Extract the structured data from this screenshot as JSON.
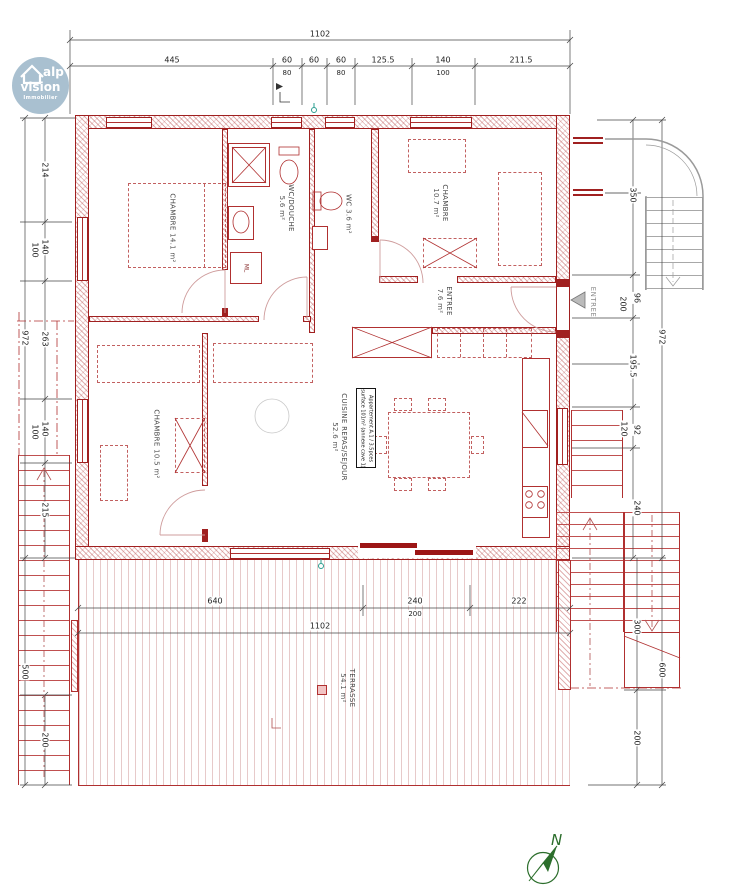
{
  "logo": {
    "brand": "alp",
    "brand2": "vision",
    "brand3": "Immobilier"
  },
  "compass": {
    "north": "N"
  },
  "apartment_box": {
    "line1": "Appartement A.1 / 3.5pces",
    "line2": "surface 101m² (annexe cave 1)"
  },
  "entrance": {
    "label": "ENTREE"
  },
  "fixtures": {
    "washing_machine": "ML"
  },
  "rooms": {
    "chambre1": {
      "name": "CHAMBRE",
      "area": "14.1 m²"
    },
    "wc_douche": {
      "name": "WC/DOUCHE",
      "area": "5.6 m²"
    },
    "wc": {
      "name": "WC",
      "area": "3.6 m²"
    },
    "chambre2": {
      "name": "CHAMBRE",
      "area": "10.7 m²"
    },
    "entree": {
      "name": "ENTREE",
      "area": "7.6 m²"
    },
    "chambre3": {
      "name": "CHAMBRE",
      "area": "10.5 m²"
    },
    "cuisine": {
      "name": "CUISINE REPAS/SEJOUR",
      "area": "52.6 m²"
    },
    "terrasse": {
      "name": "TERRASSE",
      "area": "54.1 m²"
    }
  },
  "dims": {
    "top_total": "1102",
    "top_row": [
      "445",
      "60",
      "60",
      "60",
      "125.5",
      "140",
      "211.5"
    ],
    "top_sub": [
      "80",
      "80",
      "100"
    ],
    "left": [
      "214",
      "140",
      "100",
      "263",
      "140",
      "100",
      "215",
      "200"
    ],
    "left_outer": [
      "972",
      "500"
    ],
    "right": [
      "350",
      "200",
      "96",
      "195.5",
      "120",
      "92",
      "240",
      "300",
      "200"
    ],
    "right_outer": [
      "972",
      "600"
    ],
    "bottom_row": [
      "640",
      "240",
      "222"
    ],
    "bottom_sub": [
      "200"
    ],
    "bottom_total": "1102"
  },
  "colors": {
    "wall_red": "#a02020",
    "logo_blue": "#a9c0d0",
    "compass_green": "#2c6e2c"
  }
}
